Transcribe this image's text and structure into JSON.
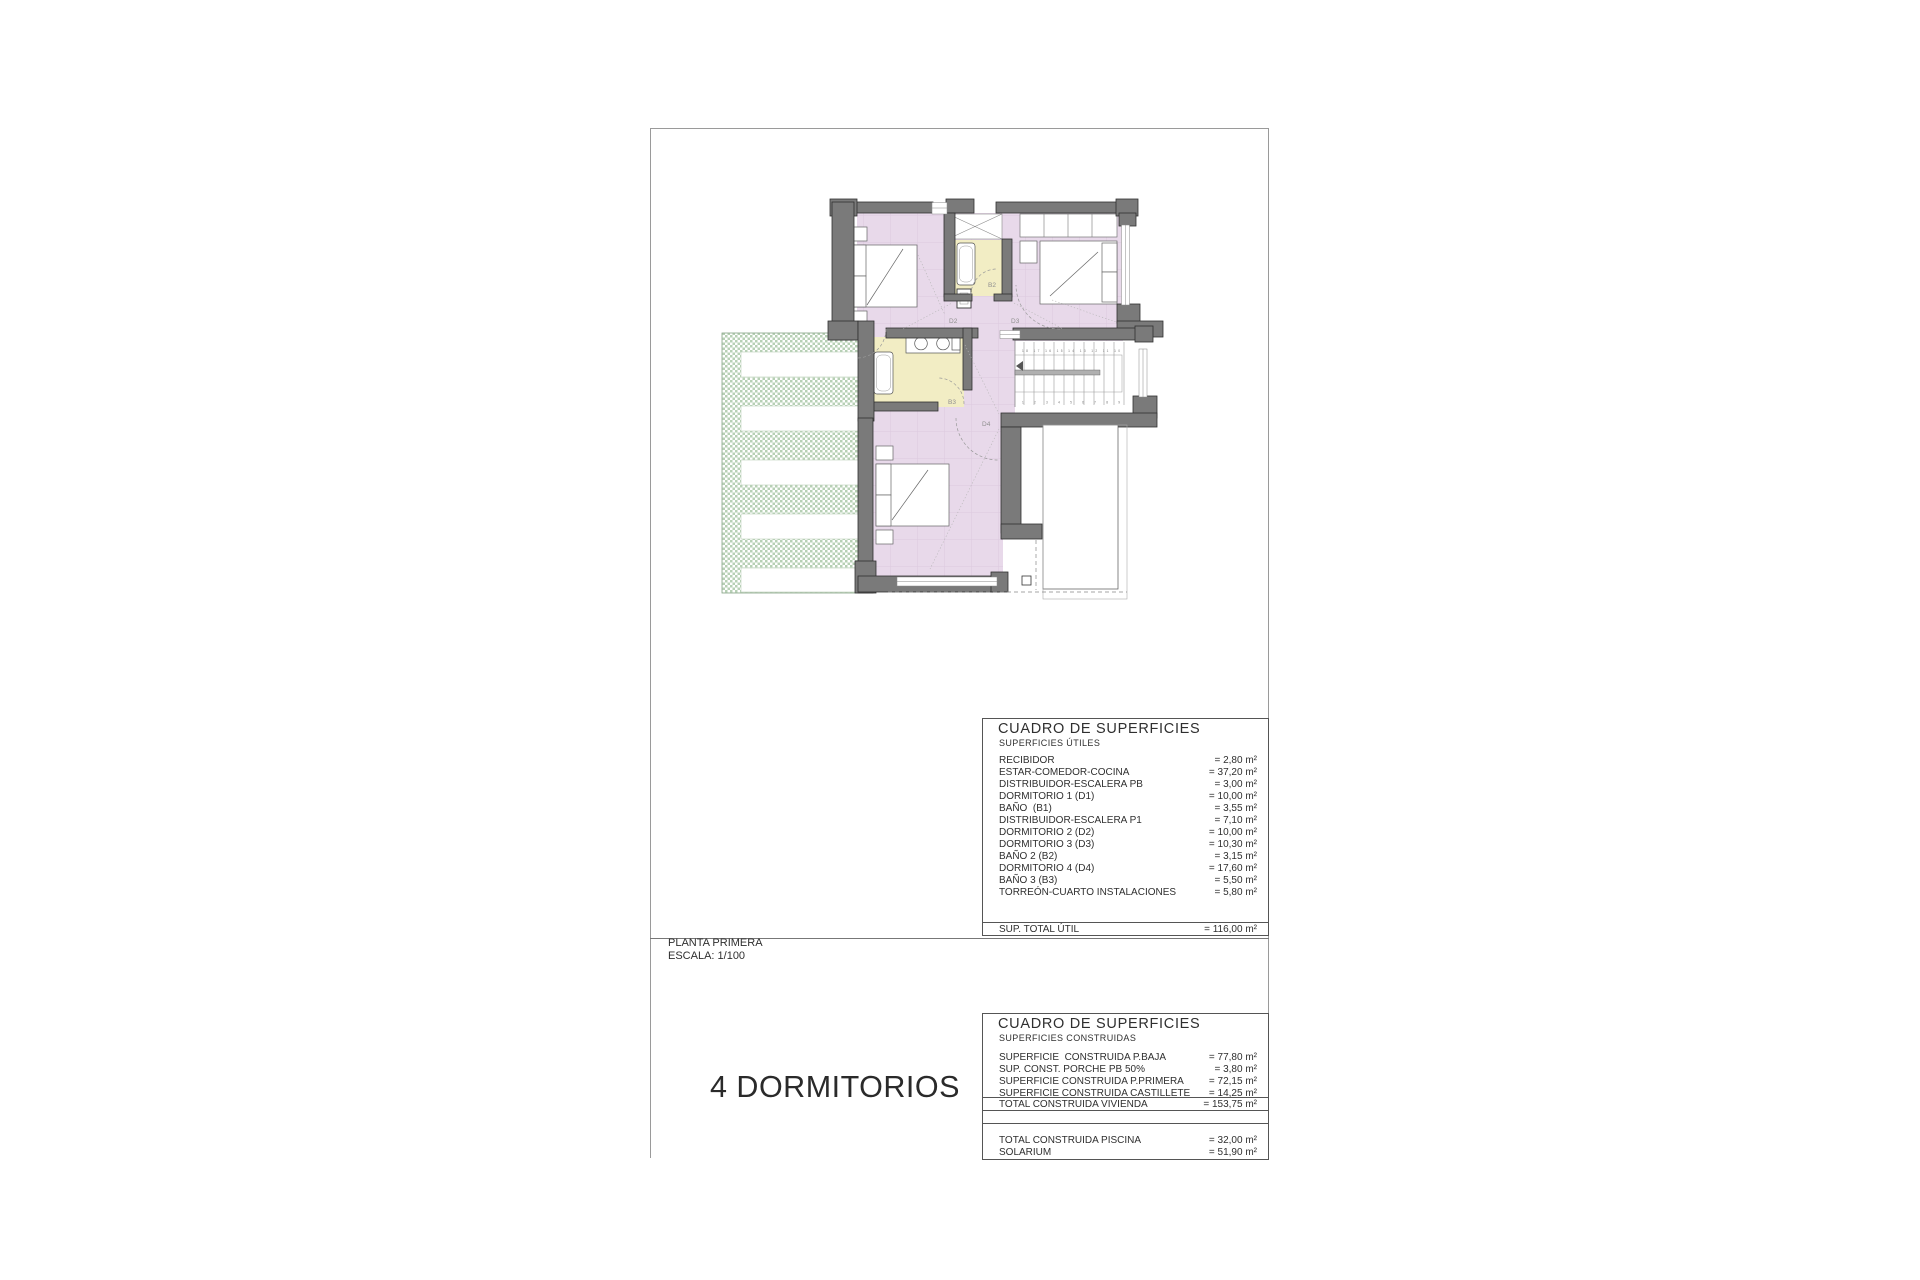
{
  "sheet": {
    "plan_note": {
      "line1": "PLANTA PRIMERA",
      "line2": "ESCALA: 1/100"
    },
    "main_title": "4 DORMITORIOS"
  },
  "plan": {
    "room_labels": {
      "d2": "D2",
      "d3": "D3",
      "b2": "B2",
      "b3": "B3",
      "d4": "D4"
    },
    "stair_numbers_top": "18 17 16 15 14 13 12 11 10",
    "stair_numbers_bottom": "1  2  3  4  5  6  7  8  9",
    "colors": {
      "room_fill": "#e8d9ea",
      "bath_fill": "#f2edc4",
      "wall_fill": "#7a7a7a",
      "terrace_green": "#b7d0b5"
    }
  },
  "tables": {
    "utiles": {
      "title": "CUADRO DE SUPERFICIES",
      "subtitle": "SUPERFICIES ÚTILES",
      "rows": [
        {
          "label": "RECIBIDOR",
          "value": "= 2,80 m²"
        },
        {
          "label": "ESTAR-COMEDOR-COCINA",
          "value": "= 37,20 m²"
        },
        {
          "label": "DISTRIBUIDOR-ESCALERA PB",
          "value": "= 3,00 m²"
        },
        {
          "label": "DORMITORIO 1 (D1)",
          "value": "= 10,00 m²"
        },
        {
          "label": "BAÑO  (B1)",
          "value": "= 3,55 m²"
        },
        {
          "label": "DISTRIBUIDOR-ESCALERA P1",
          "value": "= 7,10 m²"
        },
        {
          "label": "DORMITORIO 2 (D2)",
          "value": "= 10,00 m²"
        },
        {
          "label": "DORMITORIO 3 (D3)",
          "value": "= 10,30 m²"
        },
        {
          "label": "BAÑO 2 (B2)",
          "value": "= 3,15 m²"
        },
        {
          "label": "DORMITORIO 4 (D4)",
          "value": "= 17,60 m²"
        },
        {
          "label": "BAÑO 3 (B3)",
          "value": "= 5,50 m²"
        },
        {
          "label": "TORREÓN-CUARTO INSTALACIONES",
          "value": "= 5,80 m²"
        }
      ],
      "total": {
        "label": "SUP. TOTAL ÚTIL",
        "value": "= 116,00 m²"
      }
    },
    "construidas": {
      "title": "CUADRO DE SUPERFICIES",
      "subtitle": "SUPERFICIES CONSTRUIDAS",
      "rows": [
        {
          "label": "SUPERFICIE  CONSTRUIDA P.BAJA",
          "value": "= 77,80 m²"
        },
        {
          "label": "SUP. CONST. PORCHE PB 50%",
          "value": "= 3,80 m²"
        },
        {
          "label": "SUPERFICIE CONSTRUIDA P.PRIMERA",
          "value": "= 72,15 m²"
        },
        {
          "label": "SUPERFICIE CONSTRUIDA CASTILLETE",
          "value": "= 14,25 m²"
        }
      ],
      "total": {
        "label": "TOTAL CONSTRUIDA VIVIENDA",
        "value": "= 153,75 m²"
      },
      "extra_rows": [
        {
          "label": "TOTAL CONSTRUIDA PISCINA",
          "value": "= 32,00 m²"
        },
        {
          "label": "SOLARIUM",
          "value": "= 51,90 m²"
        }
      ]
    }
  }
}
